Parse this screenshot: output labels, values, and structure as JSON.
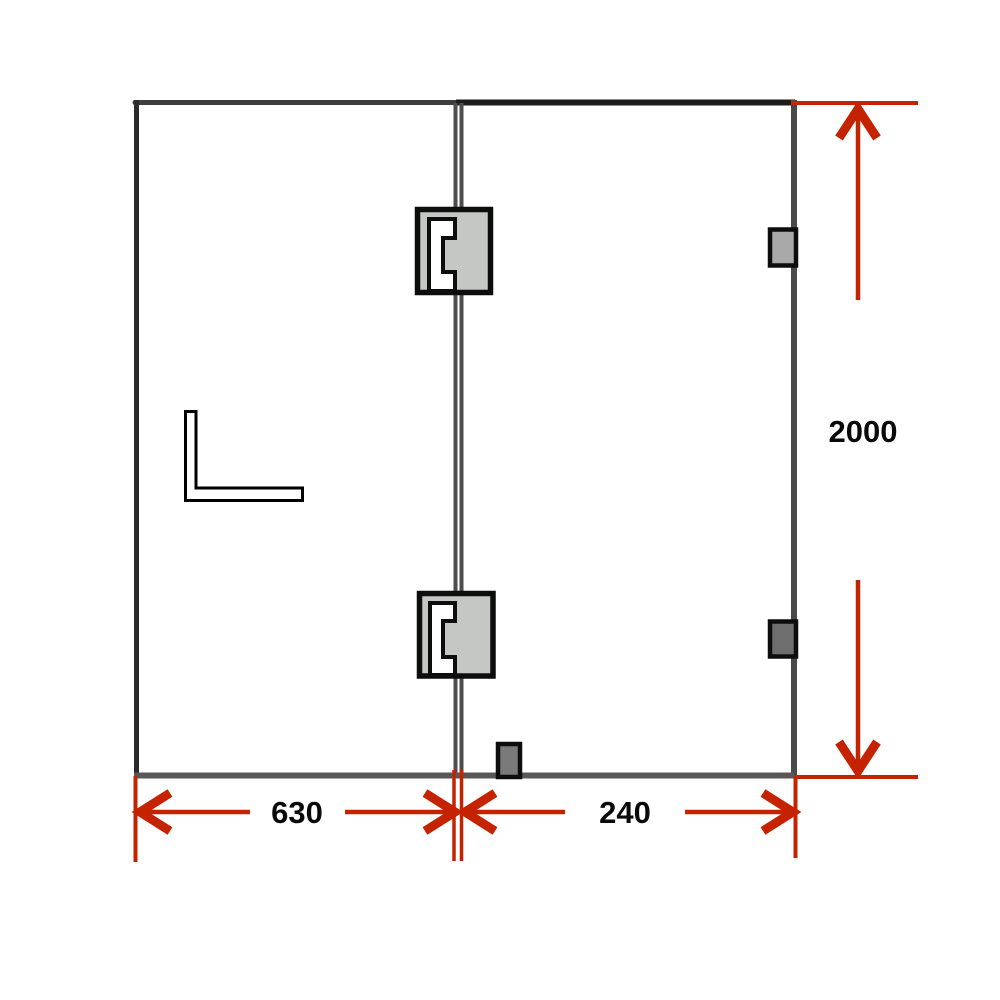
{
  "diagram": {
    "type": "technical-drawing",
    "dimensions": {
      "panel_left_width": "630",
      "panel_right_width": "240",
      "height": "2000"
    },
    "colors": {
      "dimension_red": "#c52300",
      "frame_top_left": "#3d3d3d",
      "frame_top_right": "#1c1c1c",
      "frame_left": "#2b2b2b",
      "frame_right": "#4a4a4a",
      "frame_bottom": "#585858",
      "joint_gray": "#4d4d4d",
      "hinge_fill": "#c5c7c5",
      "hinge_stroke": "#0d0d0d",
      "clamp_top_fill": "#a9a9a9",
      "clamp_bottom_fill": "#6e6e6e",
      "floor_clamp_fill": "#7a7a7a",
      "handle_fill": "#ffffff",
      "label_color": "#0a0a0a"
    },
    "parts": {
      "hinge_top": "glass-hinge",
      "hinge_bottom": "glass-hinge",
      "clamp_top": "edge-bracket",
      "clamp_bottom": "edge-bracket",
      "floor_clamp": "bottom-bracket",
      "handle": "l-bracket-handle"
    }
  }
}
